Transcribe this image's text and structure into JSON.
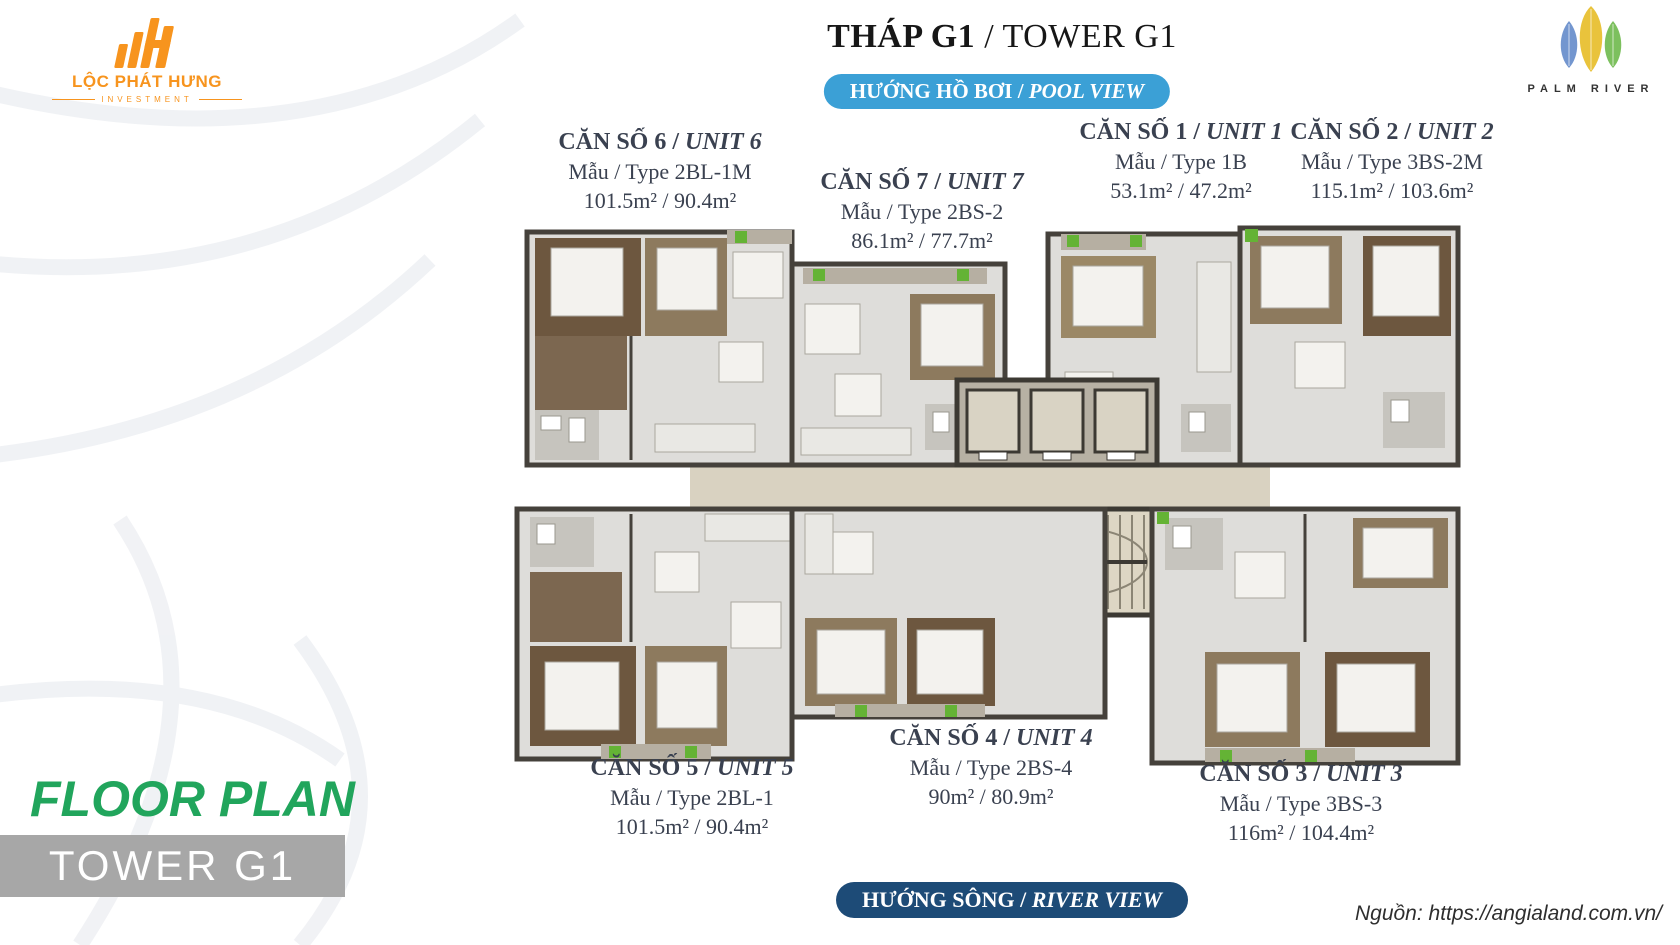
{
  "branding": {
    "developer": {
      "name": "LỘC PHÁT HƯNG",
      "division": "INVESTMENT"
    },
    "project": {
      "name": "PALM RIVER"
    }
  },
  "header": {
    "title": {
      "vi": "THÁP G1",
      "sep": " / ",
      "en": "TOWER G1"
    },
    "pool_badge": {
      "vi": "HƯỚNG HỒ BƠI",
      "sep": " / ",
      "en": "POOL VIEW"
    },
    "river_badge": {
      "vi": "HƯỚNG SÔNG",
      "sep": " / ",
      "en": "RIVER VIEW"
    }
  },
  "units": [
    {
      "key": "unit-6",
      "name_vi": "CĂN SỐ 6",
      "sep": " / ",
      "name_en": "UNIT 6",
      "type": "Mẫu / Type 2BL-1M",
      "area": "101.5m² / 90.4m²"
    },
    {
      "key": "unit-7",
      "name_vi": "CĂN SỐ 7",
      "sep": " / ",
      "name_en": "UNIT 7",
      "type": "Mẫu / Type 2BS-2",
      "area": "86.1m² / 77.7m²"
    },
    {
      "key": "unit-1",
      "name_vi": "CĂN SỐ 1",
      "sep": " / ",
      "name_en": "UNIT 1",
      "type": "Mẫu / Type 1B",
      "area": "53.1m² / 47.2m²"
    },
    {
      "key": "unit-2",
      "name_vi": "CĂN SỐ 2",
      "sep": " / ",
      "name_en": "UNIT 2",
      "type": "Mẫu / Type 3BS-2M",
      "area": "115.1m² / 103.6m²"
    },
    {
      "key": "unit-5",
      "name_vi": "CĂN SỐ 5",
      "sep": " / ",
      "name_en": "UNIT 5",
      "type": "Mẫu / Type 2BL-1",
      "area": "101.5m² / 90.4m²"
    },
    {
      "key": "unit-4",
      "name_vi": "CĂN SỐ 4",
      "sep": " / ",
      "name_en": "UNIT 4",
      "type": "Mẫu / Type 2BS-4",
      "area": "90m² / 80.9m²"
    },
    {
      "key": "unit-3",
      "name_vi": "CĂN SỐ 3",
      "sep": " / ",
      "name_en": "UNIT 3",
      "type": "Mẫu / Type 3BS-3",
      "area": "116m² / 104.4m²"
    }
  ],
  "footer": {
    "caption": "FLOOR PLAN",
    "tower_label": "TOWER G1",
    "source": "Nguồn: https://angialand.com.vn/"
  },
  "colors": {
    "brand_orange": "#f7941e",
    "pool_badge_blue": "#3ba0d6",
    "river_badge_navy": "#1d4b77",
    "floor_plan_green": "#21a55c",
    "tower_bar_gray": "#a7a7a7",
    "label_text": "#3a4150"
  }
}
